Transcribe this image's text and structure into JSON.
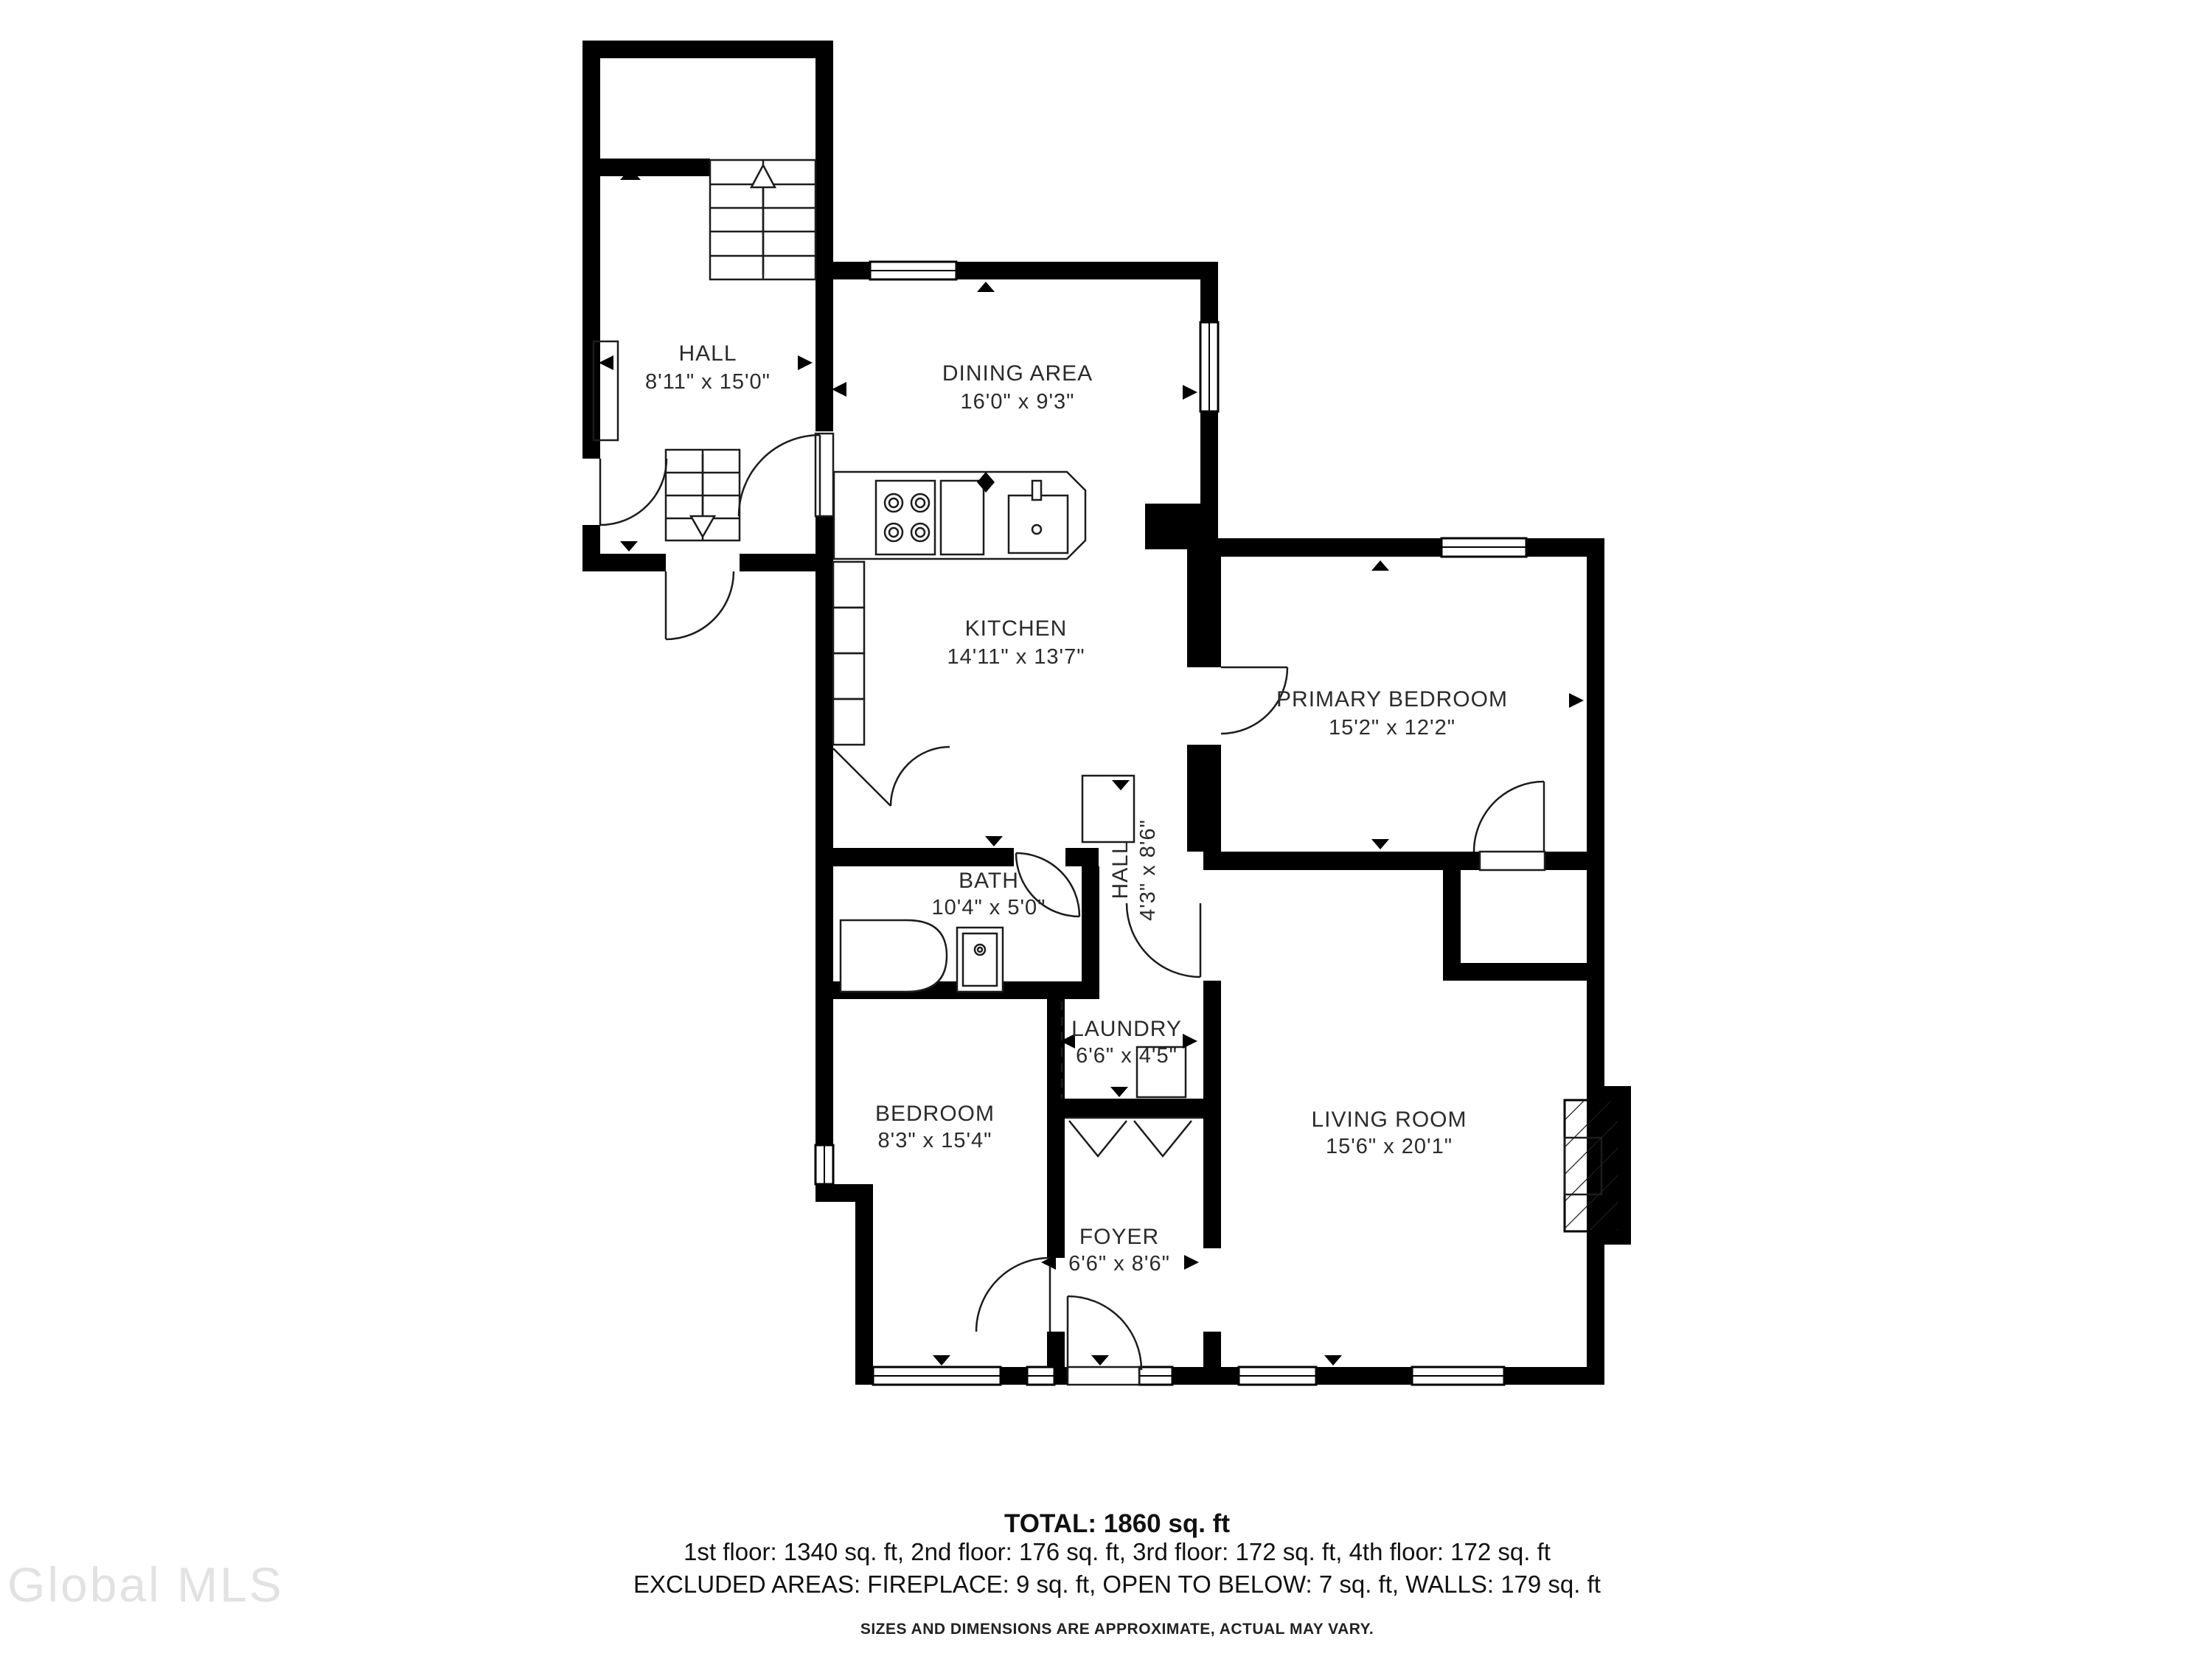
{
  "rooms": {
    "hall_upper": {
      "name": "HALL",
      "dims": "8'11\" x 15'0\""
    },
    "dining": {
      "name": "DINING AREA",
      "dims": "16'0\" x 9'3\""
    },
    "kitchen": {
      "name": "KITCHEN",
      "dims": "14'11\" x 13'7\""
    },
    "primary_bedroom": {
      "name": "PRIMARY BEDROOM",
      "dims": "15'2\" x 12'2\""
    },
    "bath": {
      "name": "BATH",
      "dims": "10'4\" x 5'0\""
    },
    "hall_corridor": {
      "name": "HALL",
      "dims": "4'3\" x 8'6\""
    },
    "laundry": {
      "name": "LAUNDRY",
      "dims": "6'6\" x 4'5\""
    },
    "bedroom": {
      "name": "BEDROOM",
      "dims": "8'3\" x 15'4\""
    },
    "living_room": {
      "name": "LIVING ROOM",
      "dims": "15'6\" x 20'1\""
    },
    "foyer": {
      "name": "FOYER",
      "dims": "6'6\" x 8'6\""
    }
  },
  "summary": {
    "total": "TOTAL: 1860 sq. ft",
    "floors": "1st floor: 1340 sq. ft, 2nd floor: 176 sq. ft, 3rd floor: 172 sq. ft, 4th floor: 172 sq. ft",
    "excluded": "EXCLUDED AREAS: FIREPLACE: 9 sq. ft, OPEN TO BELOW: 7 sq. ft, WALLS: 179 sq. ft",
    "disclaimer": "SIZES AND DIMENSIONS ARE APPROXIMATE, ACTUAL MAY VARY."
  },
  "watermark": "Global MLS",
  "colors": {
    "wall": "#000000",
    "text": "#2b2b2b",
    "watermark": "#e2e2e2"
  }
}
